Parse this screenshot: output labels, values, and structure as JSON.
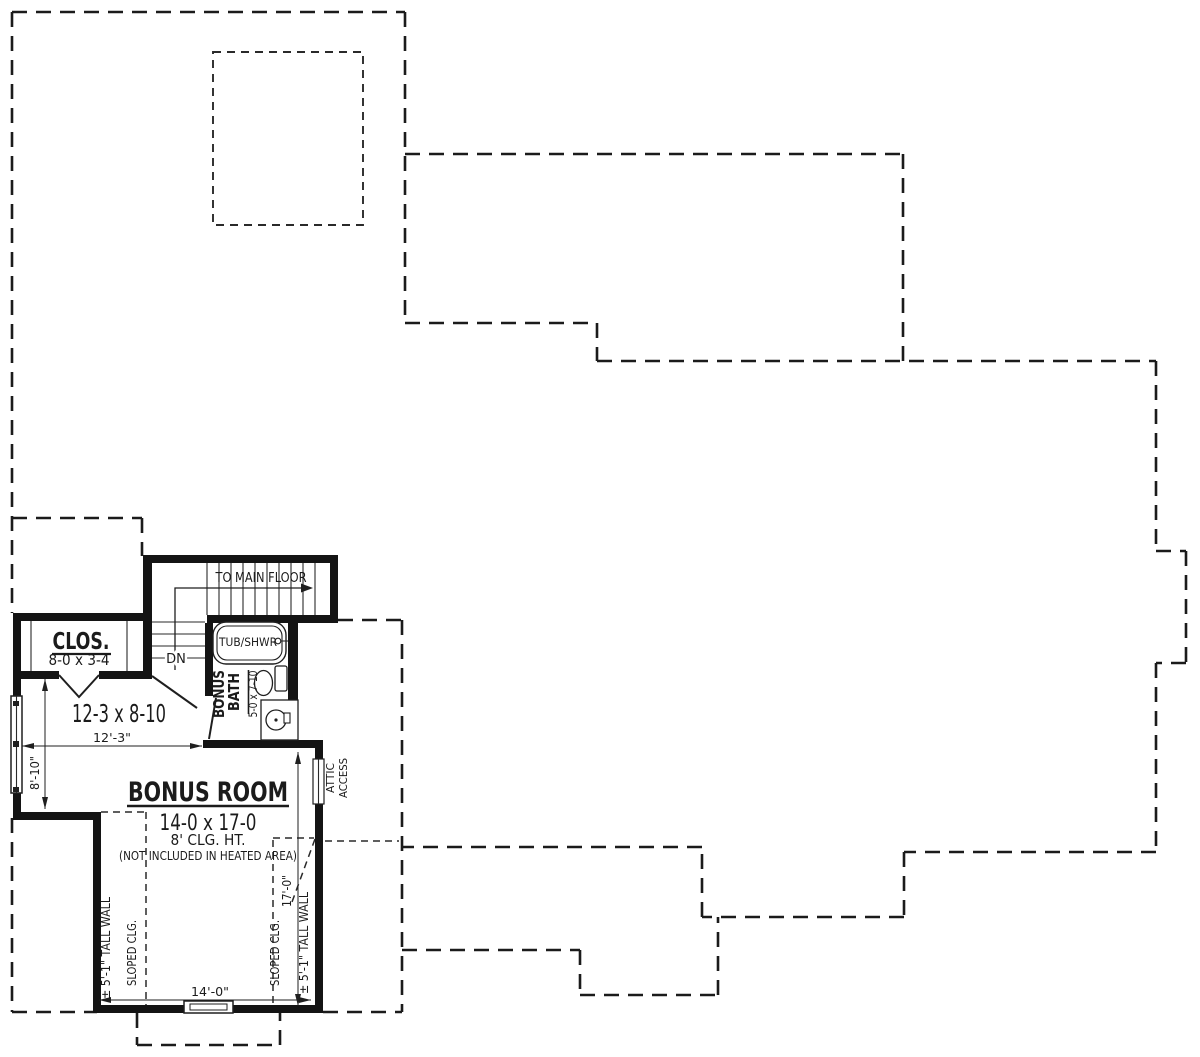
{
  "colors": {
    "ink": "#1b1b1b",
    "paper": "#ffffff"
  },
  "plan": {
    "stairs": {
      "direction_label": "TO MAIN FLOOR",
      "down_label": "DN"
    },
    "closet": {
      "name": "CLOS.",
      "size": "8-0 x 3-4"
    },
    "loft": {
      "size": "12-3 x 8-10",
      "width_dim": "12'-3\"",
      "depth_dim": "8'-10\""
    },
    "bath": {
      "name_line1": "BONUS",
      "name_line2": "BATH",
      "size": "5-0 x 7-10",
      "tub_label": "TUB/SHWR"
    },
    "bonus_room": {
      "name": "BONUS ROOM",
      "size": "14-0 x 17-0",
      "ceiling": "8' CLG. HT.",
      "note": "(NOT INCLUDED IN HEATED AREA)",
      "width_dim": "14'-0\"",
      "depth_dim": "17'-0\"",
      "tall_wall_label": "± 5'-1\" TALL WALL",
      "sloped_ceiling_label": "SLOPED CLG."
    },
    "attic": {
      "line1": "ATTIC",
      "line2": "ACCESS"
    }
  }
}
